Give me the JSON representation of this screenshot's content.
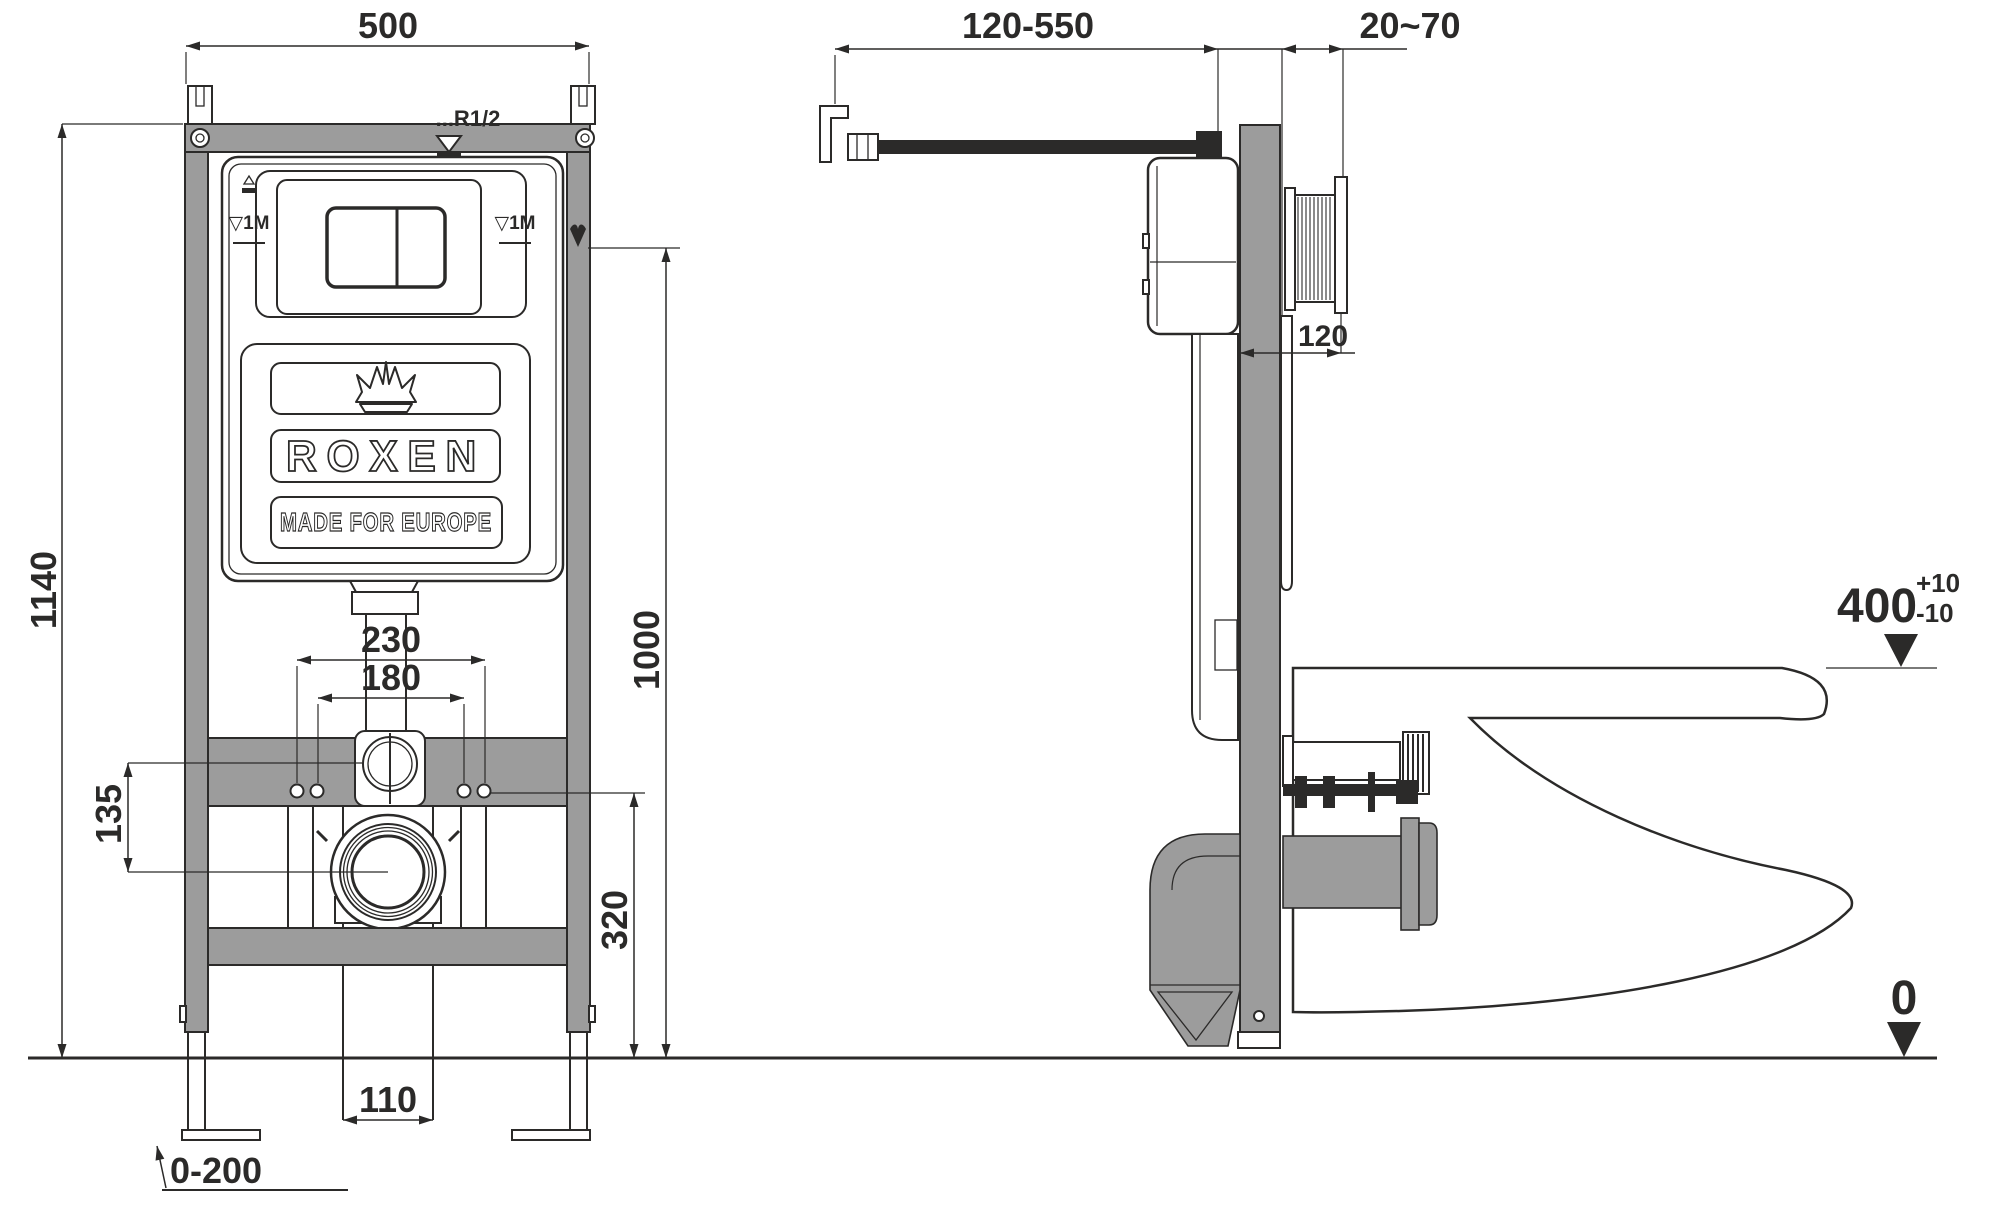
{
  "colors": {
    "line": "#2b2a29",
    "frame_gray": "#9c9c9c",
    "background": "#ffffff"
  },
  "front_view": {
    "dimensions": {
      "frame_width": "500",
      "frame_height": "1140",
      "inlet_height": "1000",
      "fixing_outer": "230",
      "fixing_inner": "180",
      "drain_offset": "135",
      "outlet_height": "320",
      "drain_width": "110",
      "leg_adjust": "0-200"
    },
    "labels": {
      "water_inlet": "...R1/2",
      "level_mark_left": "▽1M",
      "level_mark_right": "▽1M"
    },
    "brand": {
      "name": "ROXEN",
      "tagline": "MADE FOR EUROPE"
    }
  },
  "side_view": {
    "dimensions": {
      "inlet_length": "120-550",
      "wall_finish": "20~70",
      "frame_depth": "120",
      "rim_height": "400",
      "rim_tol_plus": "+10",
      "rim_tol_minus": "-10",
      "floor_level": "0"
    }
  }
}
